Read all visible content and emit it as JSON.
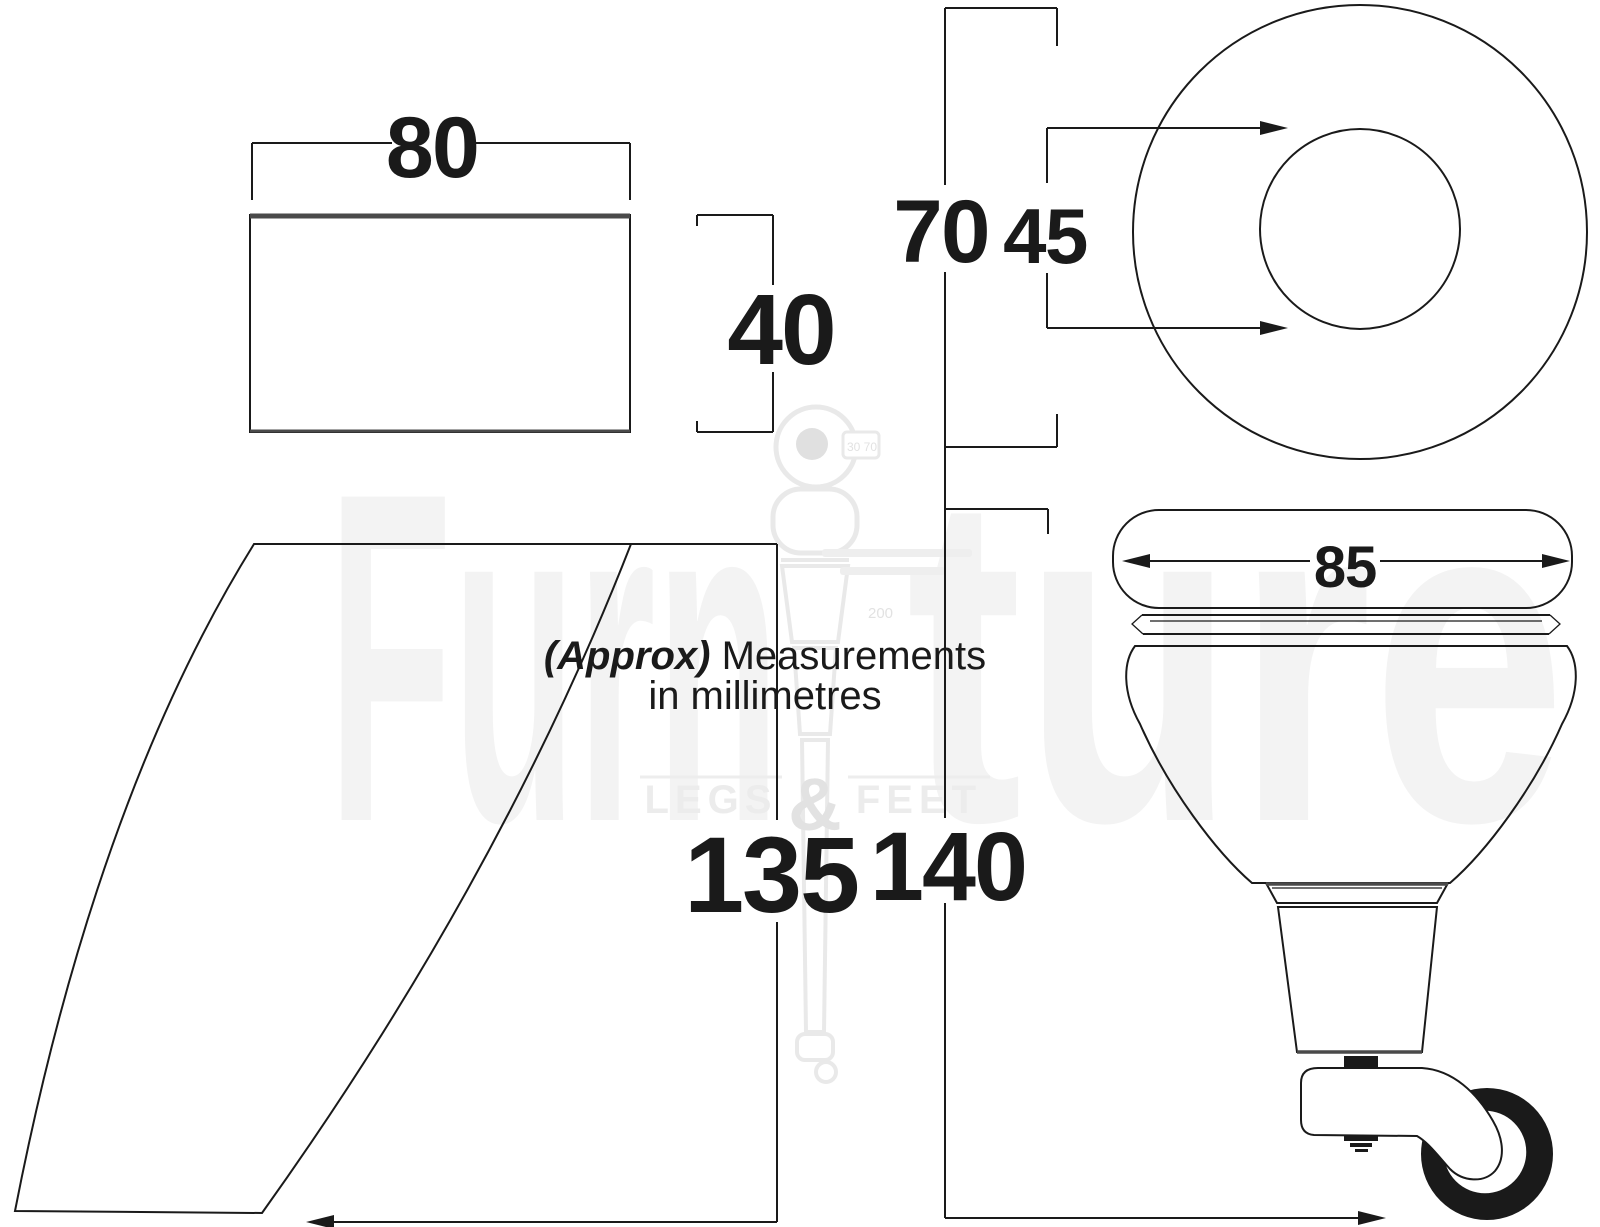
{
  "figure": {
    "note_prefix": "(Approx)",
    "note_line1": "Measurements",
    "note_line2": "in millimetres"
  },
  "dimensions": {
    "top_block": {
      "width": "80",
      "height": "40"
    },
    "top_plate": {
      "outer": "70",
      "inner": "45"
    },
    "sabre_leg": {
      "height": "135"
    },
    "castor_leg": {
      "height": "140",
      "top_width": "85"
    }
  },
  "watermark": {
    "brand_left": "Furn",
    "brand_right": "ture",
    "tagline": {
      "word1": "LEGS",
      "amp": "&",
      "word2": "FEET"
    },
    "mini_dims": {
      "top": "30 70",
      "middle": "200"
    }
  },
  "colors": {
    "background": "#ffffff",
    "line": "#1a1a1a",
    "edge_shade": "#4a4a4a",
    "watermark_light": "#f3f3f3",
    "watermark_mid": "#e9e9e9",
    "watermark_text": "#ececec"
  }
}
